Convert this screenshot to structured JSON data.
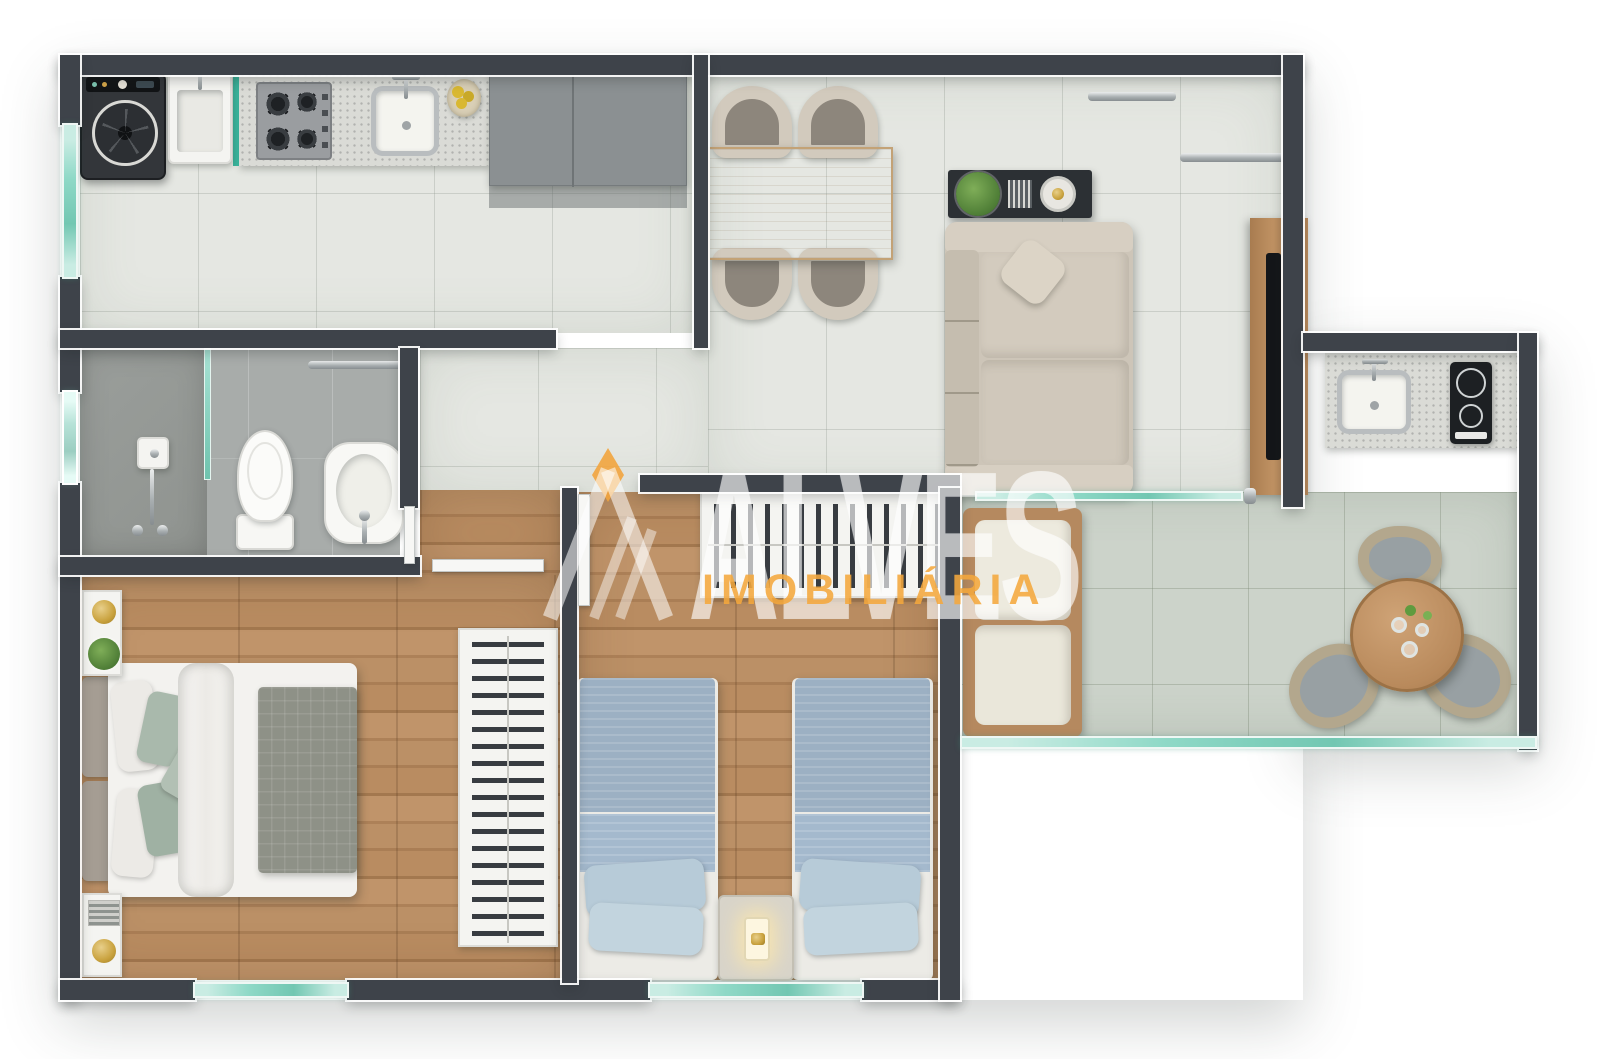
{
  "watermark": {
    "brand": "ALVES",
    "subtitle": "IMOBILIÁRIA",
    "brand_text_color": "rgba(255,255,255,0.55)",
    "subtitle_color": "#f4a73c",
    "logo": "triangle-A-monogram-with-orange-diamond"
  },
  "palette": {
    "background": "#ffffff",
    "wall": "#3e434a",
    "wall_outline": "#ffffff",
    "tile_floor": "#e5e7e2",
    "balcony_floor": "#ccd3ca",
    "bathroom_floor": "#a8acaa",
    "wood_floor": "#b78b60",
    "glass_teal": "#8fd9c7",
    "accent_orange": "#f4a73c",
    "beige_furniture": "#cfc7ba",
    "blue_bedding": "#9cb0c3",
    "sage_pillows": "#a9b9ac"
  },
  "diagram_type": "apartment-floor-plan-top-view",
  "rooms": [
    {
      "name": "kitchen-laundry",
      "floor": "light-tile",
      "furniture": [
        "washing-machine",
        "laundry-tank",
        "gas-stove-4-burners",
        "kitchen-sink",
        "fruit-bowl",
        "refrigerator",
        "granite-countertop",
        "glass-service-door"
      ]
    },
    {
      "name": "living-dining",
      "floor": "light-tile",
      "furniture": [
        "dining-table-wood",
        "dining-chair",
        "dining-chair",
        "dining-chair",
        "dining-chair",
        "sofa-beige",
        "console-table-dark",
        "potted-plant",
        "decor-tray",
        "wall-shelf",
        "wall-shelf",
        "tv-wood-panel",
        "tv"
      ]
    },
    {
      "name": "bathroom",
      "floor": "gray-tile",
      "furniture": [
        "shower-head-plate",
        "shower-glass-partition",
        "toilet",
        "washbasin",
        "towel-bar",
        "window"
      ]
    },
    {
      "name": "hall",
      "floor": "wood",
      "furniture": [
        "bathroom-door",
        "master-door",
        "bedroom2-door"
      ]
    },
    {
      "name": "master-bedroom",
      "floor": "wood",
      "furniture": [
        "double-bed",
        "headboard",
        "sage-pillows",
        "gray-quilt",
        "nightstand",
        "nightstand",
        "gold-table-lamp",
        "gold-table-lamp",
        "plant",
        "open-wardrobe-with-hangers",
        "window"
      ]
    },
    {
      "name": "bedroom-2",
      "floor": "wood",
      "furniture": [
        "single-bed-blue",
        "single-bed-blue",
        "nightstand-with-lamp",
        "open-wardrobe-with-hangers",
        "window"
      ]
    },
    {
      "name": "balcony-gourmet",
      "floor": "green-tile",
      "furniture": [
        "granite-counter",
        "counter-sink",
        "cooktop-2-burners",
        "wood-bench-with-cushions",
        "round-wood-table",
        "wicker-chair",
        "wicker-chair",
        "wicker-chair",
        "glassware",
        "glass-railing",
        "glass-partition-to-living"
      ]
    }
  ]
}
